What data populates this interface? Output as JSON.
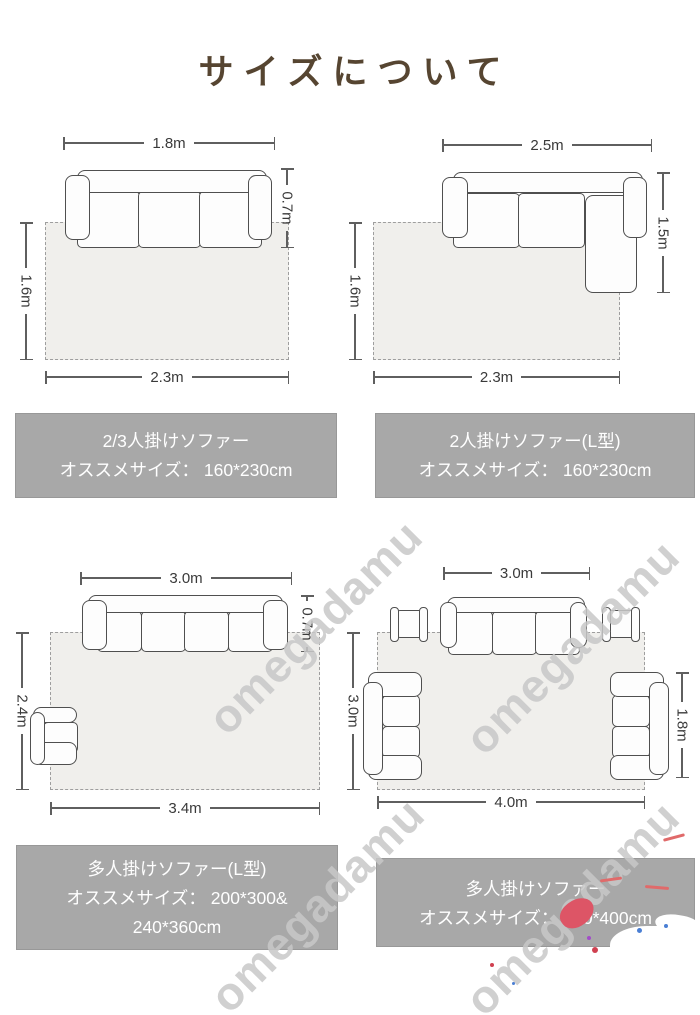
{
  "title": "サイズについて",
  "watermark": "omegadamu",
  "diagrams": [
    {
      "name": "2-3-seater-sofa",
      "dim_top": "1.8m",
      "dim_right": "0.7m",
      "dim_left": "1.6m",
      "dim_bottom": "2.3m"
    },
    {
      "name": "2-seater-l-shape-sofa",
      "dim_top": "2.5m",
      "dim_right": "1.5m",
      "dim_left": "1.6m",
      "dim_bottom": "2.3m"
    },
    {
      "name": "multi-seater-l-shape-sofa",
      "dim_top": "3.0m",
      "dim_right": "0.7m",
      "dim_left": "2.4m",
      "dim_bottom": "3.4m"
    },
    {
      "name": "multi-seater-sofa-set",
      "dim_top": "3.0m",
      "dim_right": "1.8m",
      "dim_left": "3.0m",
      "dim_bottom": "4.0m"
    }
  ],
  "captions": [
    {
      "line1": "2/3人掛けソファー",
      "line2": "オススメサイズ： 160*230cm"
    },
    {
      "line1": "2人掛けソファー(L型)",
      "line2": "オススメサイズ： 160*230cm"
    },
    {
      "line1": "多人掛けソファー(L型)",
      "line2": "オススメサイズ： 200*300&",
      "line3": "240*360cm"
    },
    {
      "line1": "多人掛けソファー",
      "line2": "オススメサイズ： 300*400cm"
    }
  ],
  "colors": {
    "title_text": "#564531",
    "caption_background": "#a8a8a8",
    "caption_text": "#ffffff",
    "rug_fill": "#f0efec",
    "line": "#5f5f5f",
    "watermark": "#c8c8c8",
    "sticker_red": "#dd5566"
  }
}
